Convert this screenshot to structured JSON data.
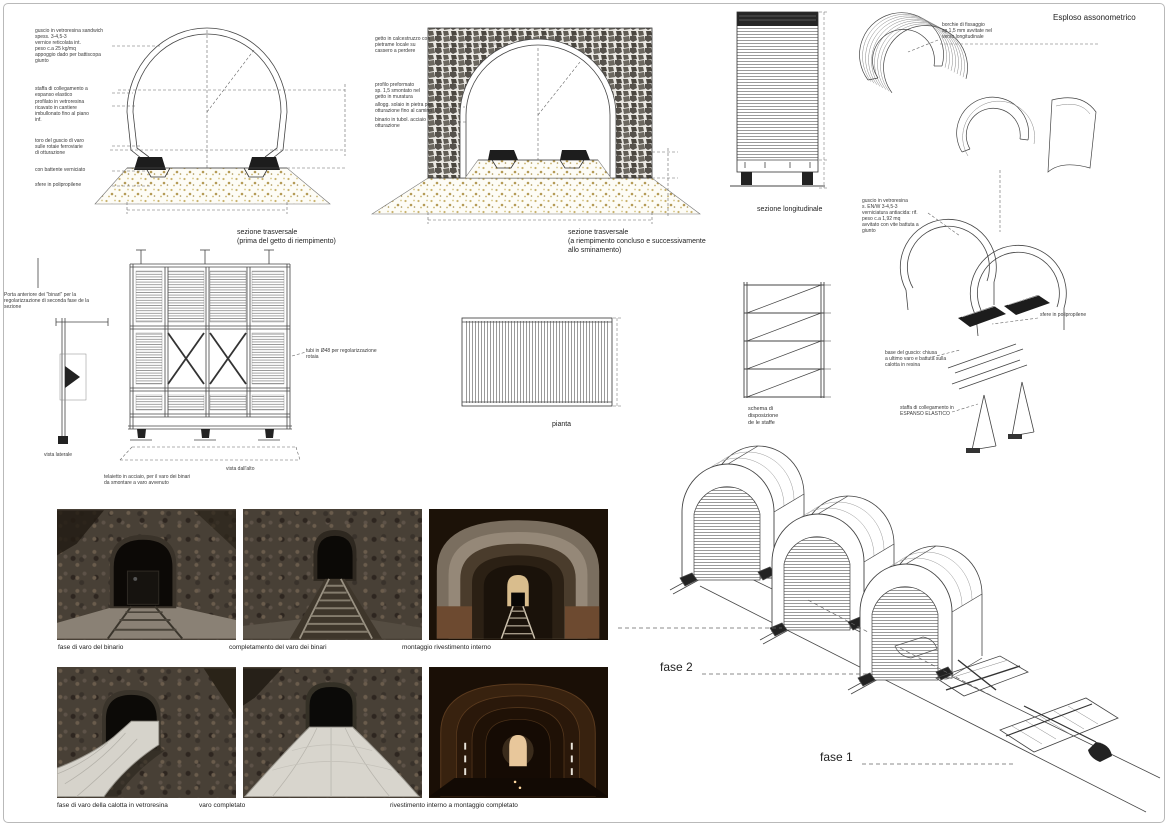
{
  "colors": {
    "line": "#444444",
    "gravel": "#c0ad72",
    "stone": "#55514b",
    "paper": "#ffffff"
  },
  "drawings": {
    "section1": {
      "caption": "sezione trasversale\n(prima del getto di riempimento)",
      "ann_shell": "guscio in vetroresina sandwich\nspess. 3-4,5-3\nvernice reticolata int.\npeso c.a 25 kg/mq\nappoggio dado per battiscopa\ngiunto",
      "ann_staffa": "staffa di collegamento a\nespanso elastico",
      "ann_profilo": "profilato in vetroresina\nricavato in cantiere\nimbullonato fino al piano\ninf.",
      "ann_toro": "toro del guscio di varo\nsulle rotaie ferroviarie\ndi otturazione",
      "ann_battente": "con battente verniciato",
      "ann_sfere": "sfere in polipropilene"
    },
    "section2": {
      "caption": "sezione trasversale\n(a riempimento concluso e successivamente\nallo sminamento)",
      "ann_getto": "getto in calcestruzzo con\npietrame locale su\ncassero a perdere",
      "ann_profilo": "profilo preformato\nsp. 1,5 smontato nel\ngetto in muratura",
      "ann_alloggio": "allogg. solaio in pietra per\notturazione fino al camino",
      "ann_binario": "binario in tubol. acciaio\notturazione"
    },
    "longitudinale": {
      "caption": "sezione longitudinale"
    },
    "pianta": {
      "caption": "pianta"
    },
    "schema": {
      "caption": "schema di\ndisposizione\nde le staffe"
    },
    "formwork": {
      "ann_porta": "Porta anteriore dei \"binari\" per la\nregolarizzazione di seconda fase de la\nsezione",
      "ann_tubi": "tubi in Ø48 per regolarizzazione\nrotaia",
      "vista_laterale": "vista laterale",
      "vista_alto": "vista dall'alto",
      "ann_telaietto": "telaietto in acciaio, per il varo dei binari\nda smontare a varo avvenuto"
    },
    "esploso": {
      "title": "Esploso assonometrico",
      "ann_borchie": "borchie di fissaggio\nsp 1,5 mm avvitate nel\nverso longitudinale",
      "ann_guscio": "guscio in vetroresina\ns. EN/W 3-4,5-3\nverniciatura antiacida: rif.\npeso c.a 1,92 mq\navvitato con vite battuta a\ngiunto",
      "ann_sfere": "sfere in polipropilene",
      "ann_base": "base del guscio: chiusa\na ultimo varo e battuta sulla\ncalotta in resina",
      "ann_staffa": "staffa di collegamento in\nESPANSO ELASTICO"
    },
    "fasi": {
      "fase1": "fase 1",
      "fase2": "fase 2"
    }
  },
  "photos": [
    {
      "caption": "fase di varo del binario"
    },
    {
      "caption": "completamento del varo dei binari"
    },
    {
      "caption": "montaggio rivestimento interno"
    },
    {
      "caption": "fase di varo della calotta in vetroresina"
    },
    {
      "caption": "varo completato"
    },
    {
      "caption": "rivestimento interno a montaggio completato"
    }
  ]
}
